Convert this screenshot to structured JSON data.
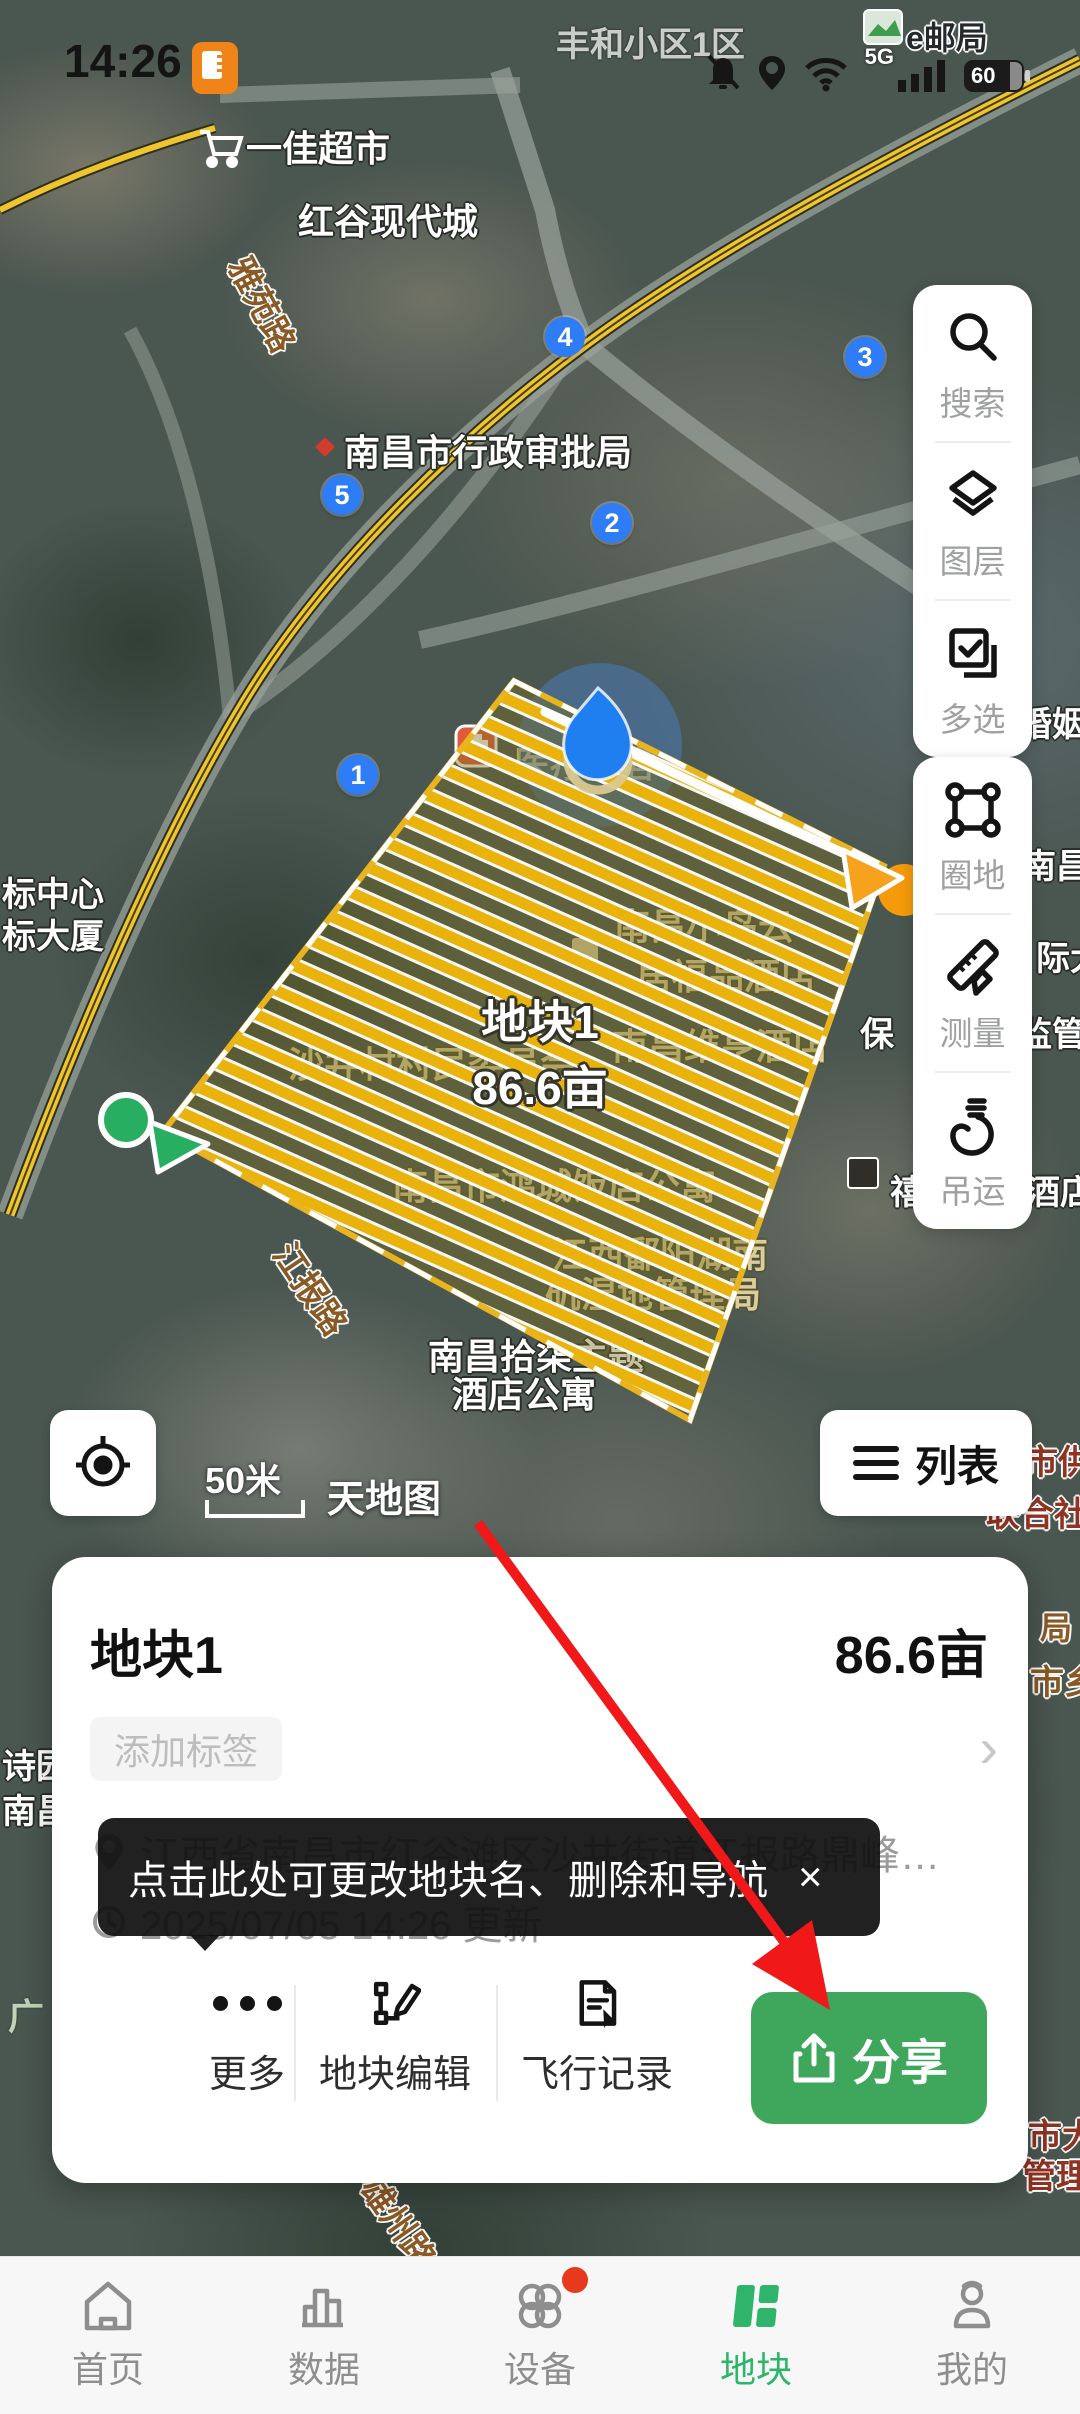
{
  "status_bar": {
    "time": "14:26",
    "network": "5G",
    "battery": "60"
  },
  "map": {
    "attribution": "天地图",
    "scale_label": "50米",
    "plot": {
      "name": "地块1",
      "area": "86.6亩"
    },
    "labels": [
      {
        "t": "丰和小区1区",
        "x": 556,
        "y": 28,
        "v": "dim",
        "fs": 34
      },
      {
        "t": "e邮局",
        "x": 906,
        "y": 22,
        "v": "dark",
        "fs": 32
      },
      {
        "t": "一佳超市",
        "x": 246,
        "y": 130,
        "v": "white",
        "fs": 36
      },
      {
        "t": "红谷现代城",
        "x": 298,
        "y": 203,
        "v": "white",
        "fs": 36
      },
      {
        "t": "雅苑路",
        "x": 252,
        "y": 252,
        "v": "road",
        "fs": 34,
        "rot": 62
      },
      {
        "t": "南昌市行政审批局",
        "x": 344,
        "y": 434,
        "v": "white",
        "fs": 36
      },
      {
        "t": "新区婚姻登",
        "x": 950,
        "y": 708,
        "v": "white",
        "fs": 34
      },
      {
        "t": "南昌市",
        "x": 1022,
        "y": 850,
        "v": "white",
        "fs": 34
      },
      {
        "t": "标中心",
        "x": 2,
        "y": 878,
        "v": "white",
        "fs": 34
      },
      {
        "t": "标大厦",
        "x": 2,
        "y": 920,
        "v": "white",
        "fs": 34
      },
      {
        "t": "际大",
        "x": 1036,
        "y": 942,
        "v": "white",
        "fs": 34
      },
      {
        "t": "保",
        "x": 860,
        "y": 1018,
        "v": "white",
        "fs": 34
      },
      {
        "t": "监管",
        "x": 1018,
        "y": 1018,
        "v": "white",
        "fs": 34
      },
      {
        "t": "禧悦丽尊酒店",
        "x": 890,
        "y": 1176,
        "v": "white",
        "fs": 34
      },
      {
        "t": "南昌市供销",
        "x": 956,
        "y": 1446,
        "v": "red",
        "fs": 34
      },
      {
        "t": "联合社",
        "x": 986,
        "y": 1498,
        "v": "red",
        "fs": 34
      },
      {
        "t": "诗园",
        "x": 2,
        "y": 1750,
        "v": "white",
        "fs": 34
      },
      {
        "t": "南昌",
        "x": 2,
        "y": 1795,
        "v": "white",
        "fs": 34
      },
      {
        "t": "局",
        "x": 1040,
        "y": 1612,
        "v": "road",
        "fs": 32
      },
      {
        "t": "市乡",
        "x": 1030,
        "y": 1666,
        "v": "road",
        "fs": 34
      },
      {
        "t": "市大",
        "x": 1028,
        "y": 2120,
        "v": "red",
        "fs": 34
      },
      {
        "t": "管理",
        "x": 1022,
        "y": 2160,
        "v": "red",
        "fs": 34
      },
      {
        "t": "雄州路",
        "x": 382,
        "y": 2172,
        "v": "road",
        "fs": 34,
        "rot": 55
      },
      {
        "t": "广",
        "x": 8,
        "y": 1998,
        "v": "pale",
        "fs": 36
      },
      {
        "t": "医疗美容",
        "x": 514,
        "y": 746,
        "v": "khaki",
        "fs": 36
      },
      {
        "t": "南昌小鸟云",
        "x": 614,
        "y": 908,
        "v": "khaki",
        "fs": 36
      },
      {
        "t": "居福品酒店",
        "x": 636,
        "y": 958,
        "v": "khaki",
        "fs": 36
      },
      {
        "t": "南昌维亨酒店",
        "x": 612,
        "y": 1028,
        "v": "khaki",
        "fs": 36
      },
      {
        "t": "沙井村村民委员会",
        "x": 288,
        "y": 1046,
        "v": "khaki",
        "fs": 36
      },
      {
        "t": "南昌市鸿城饭店公寓",
        "x": 392,
        "y": 1168,
        "v": "khaki",
        "fs": 36
      },
      {
        "t": "江西鄱阳湖南",
        "x": 552,
        "y": 1236,
        "v": "khaki",
        "fs": 36
      },
      {
        "t": "矶湿地管理局",
        "x": 545,
        "y": 1276,
        "v": "khaki",
        "fs": 36
      },
      {
        "t": "南昌拾柒主题",
        "x": 428,
        "y": 1338,
        "v": "white",
        "fs": 36
      },
      {
        "t": "酒店公寓",
        "x": 452,
        "y": 1376,
        "v": "white",
        "fs": 36
      },
      {
        "t": "江报路",
        "x": 295,
        "y": 1238,
        "v": "road",
        "fs": 34,
        "rot": 56
      }
    ],
    "route_markers": [
      {
        "n": "1",
        "x": 358,
        "y": 775
      },
      {
        "n": "2",
        "x": 612,
        "y": 523
      },
      {
        "n": "3",
        "x": 865,
        "y": 357
      },
      {
        "n": "4",
        "x": 565,
        "y": 337
      },
      {
        "n": "5",
        "x": 342,
        "y": 495
      }
    ]
  },
  "toolbar": {
    "groups": [
      {
        "items": [
          {
            "label": "搜索"
          },
          {
            "label": "图层"
          },
          {
            "label": "多选"
          }
        ]
      },
      {
        "items": [
          {
            "label": "圈地"
          },
          {
            "label": "测量"
          },
          {
            "label": "吊运"
          }
        ]
      }
    ]
  },
  "list_button": "列表",
  "sheet": {
    "title": "地块1",
    "area": "86.6亩",
    "tag_placeholder": "添加标签",
    "chevron": "›",
    "address": "江西省南昌市红谷滩区沙井街道江报路鼎峰…",
    "updated": "2025/07/05 14:26 更新",
    "tooltip": {
      "text": "点击此处可更改地块名、删除和导航",
      "close": "×"
    },
    "actions": [
      {
        "label": "更多"
      },
      {
        "label": "地块编辑"
      },
      {
        "label": "飞行记录"
      }
    ],
    "share_label": "分享"
  },
  "nav": {
    "items": [
      {
        "label": "首页",
        "active": false,
        "badge": false
      },
      {
        "label": "数据",
        "active": false,
        "badge": false
      },
      {
        "label": "设备",
        "active": false,
        "badge": true
      },
      {
        "label": "地块",
        "active": true,
        "badge": false
      },
      {
        "label": "我的",
        "active": false,
        "badge": false
      }
    ]
  },
  "colors": {
    "accent_green": "#3EA75C",
    "nav_active": "#2FB56B",
    "plot_stripe": "#E9B30B",
    "marker_blue": "#2E7CF6",
    "arrow_red": "#F01818",
    "badge_red": "#E8391D"
  }
}
